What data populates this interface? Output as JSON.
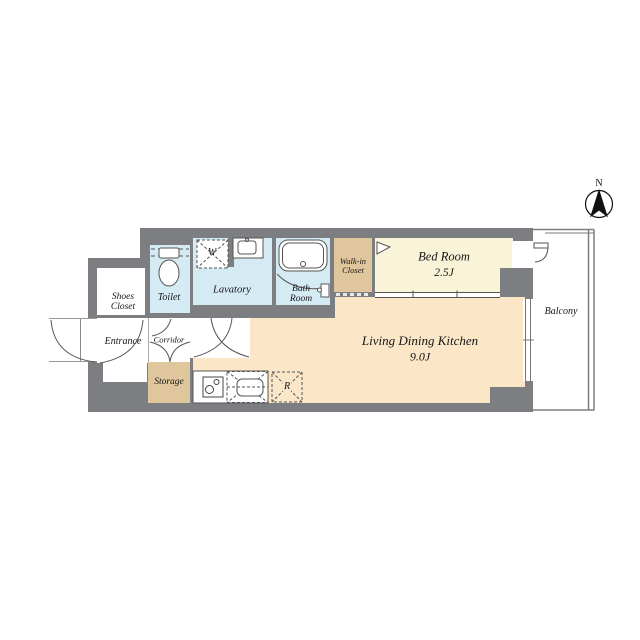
{
  "plan": {
    "title": "1K apartment floor plan",
    "north_label": "N",
    "balcony_label": "Balcony",
    "rooms": {
      "shoes_closet": {
        "label": "Shoes\nCloset"
      },
      "toilet": {
        "label": "Toilet"
      },
      "lavatory": {
        "label": "Lavatory"
      },
      "bath_room": {
        "label": "Bath\nRoom"
      },
      "walk_in_closet": {
        "label": "Walk-in\nCloset"
      },
      "bed_room": {
        "label": "Bed Room",
        "size": "2.5J"
      },
      "living_dining_kitchen": {
        "label": "Living Dining Kitchen",
        "size": "9.0J"
      },
      "entrance": {
        "label": "Entrance"
      },
      "corridor": {
        "label": "Corridor"
      },
      "storage": {
        "label": "Storage"
      }
    },
    "fixtures": {
      "washing_machine_space": "W",
      "refrigerator_space": "R"
    },
    "colors": {
      "wall": "#7c7e81",
      "ldk_floor": "#fbe7c8",
      "bedroom_floor": "#f9f4d8",
      "closet_tan": "#e0c69c",
      "wet_area_blue": "#d5ebf4",
      "line": "#555555"
    }
  }
}
